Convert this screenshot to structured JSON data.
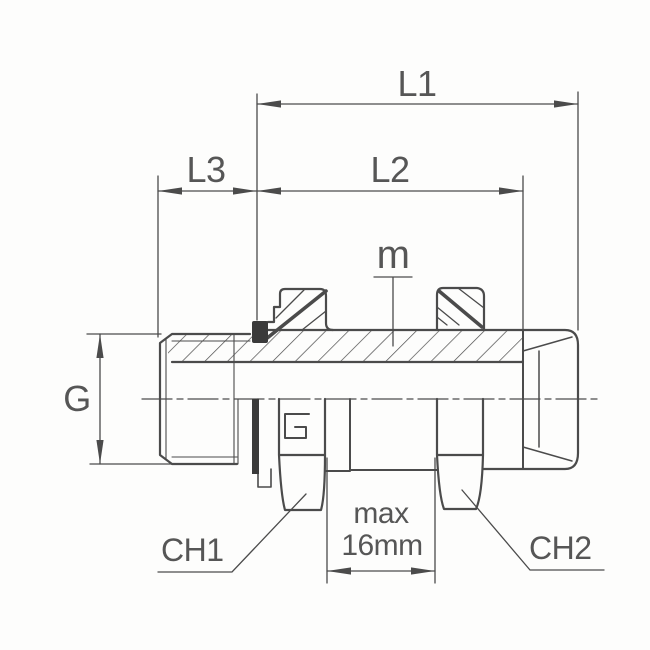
{
  "page": {
    "background": "#fdfdfc"
  },
  "drawing": {
    "line_color": "#4b4b4b",
    "text_color": "#565656",
    "seal_color": "#3a3a3a",
    "labels": {
      "l1": "L1",
      "l2": "L2",
      "l3": "L3",
      "g": "G",
      "m": "m",
      "max_line1": "max",
      "max_line2": "16mm",
      "ch1": "CH1",
      "ch2": "CH2"
    }
  }
}
